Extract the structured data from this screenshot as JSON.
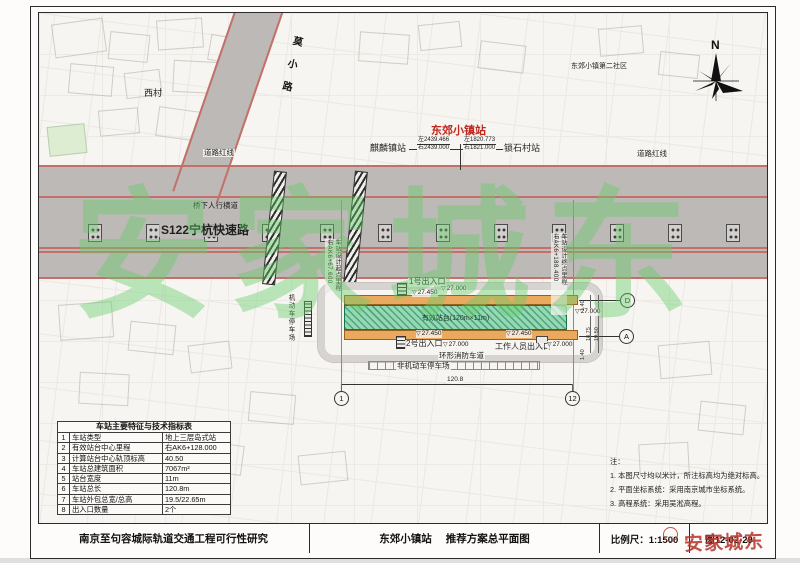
{
  "title_block": {
    "project": "南京至句容城际轨道交通工程可行性研究",
    "station": "东郊小镇站",
    "drawing": "推荐方案总平面图",
    "scale": "比例尺：1:1500",
    "figure_no": "图12-02-29"
  },
  "spec_table": {
    "title": "车站主要特征与技术指标表",
    "rows": [
      [
        "1",
        "车站类型",
        "地上三层岛式站"
      ],
      [
        "2",
        "有效站台中心里程",
        "右AK6+128.000"
      ],
      [
        "3",
        "计算站台中心轨顶标高",
        "40.50"
      ],
      [
        "4",
        "车站总建筑面积",
        "7067m²"
      ],
      [
        "5",
        "站台宽度",
        "11m"
      ],
      [
        "6",
        "车站总长",
        "120.8m"
      ],
      [
        "7",
        "车站外包总宽/总高",
        "19.5/22.65m"
      ],
      [
        "8",
        "出入口数量",
        "2个"
      ]
    ]
  },
  "notes": {
    "heading": "注：",
    "items": [
      "1. 本图尺寸均以米计，所注标高均为绝对标高。",
      "2. 平面坐标系统：采用南京城市坐标系统。",
      "3. 高程系统：采用吴淞高程。"
    ]
  },
  "line_diagram": {
    "center_station": "东郊小镇站",
    "left_station": "麒麟镇站",
    "right_station": "锁石村站",
    "left_top": "左2439.466",
    "left_bottom": "右2439.000",
    "right_top": "左1820.773",
    "right_bottom": "右1821.000"
  },
  "map": {
    "diag_road": "莫小路",
    "west_village": "西村",
    "red_line_left": "道路红线",
    "red_line_right": "道路红线",
    "community": "东郊小镇第二社区",
    "expressway": "S122宁杭快速路",
    "ped_crossing": "桥下人行横道",
    "compass_n": "N",
    "start_chainage": "右AK6+67.600",
    "start_label": "车站设计起点里程",
    "end_chainage": "右AK6+188.400",
    "end_label": "车站设计终点里程",
    "platform_label": "有效站台(120m×11m)",
    "entrance1": "1号出入口",
    "entrance2": "2号出入口",
    "staff_entrance": "工作人员出入口",
    "ring_road": "环形消防车道",
    "nonmotor_parking": "非机动车停车场",
    "motor_parking": "机动车停车场"
  },
  "levels": {
    "upper": "27.450",
    "base": "27.000"
  },
  "dims": {
    "total": "120.8",
    "w1": "18.75",
    "w2": "19.50",
    "e1": "1.40"
  },
  "axes": {
    "left": "1",
    "right": "12",
    "top": "D",
    "bottom": "A"
  },
  "watermarks": {
    "large": "安家城东",
    "small": "安家城东"
  },
  "colors": {
    "station_red": "#c0281e",
    "watermark_green": "#64cd69",
    "watermark_red": "#b7372d",
    "road_red_line": "#c4706a",
    "platform_green": "#93d9b4",
    "band_orange": "#e9a95e"
  }
}
